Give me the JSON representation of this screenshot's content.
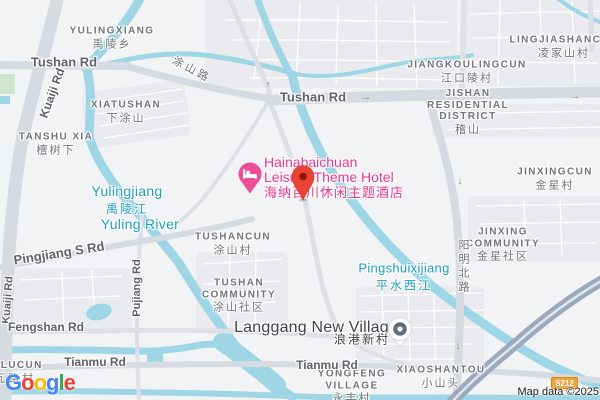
{
  "map": {
    "poi": {
      "hotel": {
        "name_line1": "Hainabaichuan",
        "name_line2": "Leisure Theme Hotel",
        "name_zh": "海纳百川休闲主题酒店",
        "pin_color": "#EF4C9A",
        "icon": "bed-icon"
      }
    },
    "markers": {
      "destination": {
        "color": "#E94335",
        "inner_color": "#971106"
      },
      "village_pin": {
        "color": "#5E6E7E"
      }
    },
    "areas": {
      "yulingxiang": {
        "en": "YULINGXIANG",
        "zh": "禹陵乡"
      },
      "lingjiashancun": {
        "en": "LINGJIASHANCUN",
        "zh": "凌家山村"
      },
      "jiangkoulingcun": {
        "en": "JIANGKOULINGCUN",
        "zh": "江口陵村"
      },
      "jishan": {
        "l1": "JISHAN",
        "l2": "RESIDENTIAL",
        "l3": "DISTRICT",
        "zh": "稽山"
      },
      "xiatushan": {
        "en": "XIATUSHAN",
        "zh": "下涂山"
      },
      "tanshu_xia": {
        "en": "TANSHU XIA",
        "zh": "檀树下"
      },
      "tushancun": {
        "en": "TUSHANCUN",
        "zh": "涂山村"
      },
      "tushan_community": {
        "l1": "TUSHAN",
        "l2": "COMMUNITY",
        "zh": "涂山社区"
      },
      "jinxingcun": {
        "en": "JINXINGCUN",
        "zh": "金星村"
      },
      "jinxing_community": {
        "l1": "JINXING",
        "l2": "COMMUNITY",
        "zh": "金星社区"
      },
      "langgang": {
        "en": "Langgang New Village",
        "zh": "浪港新村"
      },
      "yongfeng": {
        "l1": "YONGFENG",
        "l2": "VILLAGE",
        "zh": "永丰村"
      },
      "xiaoshantou": {
        "en": "XIAOSHANTOU",
        "zh": "小山头"
      },
      "hilucun": {
        "en": "HILUCUN",
        "zh": "瓦路村"
      }
    },
    "roads": {
      "tushan_rd_left": "Tushan Rd",
      "tushan_rd_right": "Tushan Rd",
      "tushan_lu_zh": "涂山路",
      "kuaiji_rd_top": "Kuaiji Rd",
      "kuaiji_rd_bottom": "Kuaiji Rd",
      "pingjiang_s_rd": "Pingjiang S Rd",
      "pujiang_rd": "Pujiang Rd",
      "yangming_n_rd_zh": "阳明北路",
      "fengshan_rd": "Fengshan Rd",
      "tianmu_rd_left": "Tianmu Rd",
      "tianmu_rd_mid": "Tianmu Rd",
      "route_shield": "S212"
    },
    "water": {
      "yulingjiang": {
        "en": "Yulingjiang",
        "zh": "禹陵江"
      },
      "yuling_river": "Yuling River",
      "pingshuixijiang": {
        "en": "Pingshuixijiang",
        "zh": "平水西江"
      }
    },
    "icons": {
      "arrow_up": "↑",
      "arrow_down": "↓",
      "arrow_right": "→"
    },
    "attribution": "Map data ©2025",
    "logo": {
      "letters": [
        {
          "ch": "G",
          "color": "#4285F4"
        },
        {
          "ch": "o",
          "color": "#EA4335"
        },
        {
          "ch": "o",
          "color": "#FBBC05"
        },
        {
          "ch": "g",
          "color": "#4285F4"
        },
        {
          "ch": "l",
          "color": "#34A853"
        },
        {
          "ch": "e",
          "color": "#EA4335"
        }
      ]
    },
    "colors": {
      "background": "#F2F3F4",
      "urban_block": "#E9EBEE",
      "water": "#9FD6E6",
      "water_label": "#1F9CBE",
      "major_road": "#D6DBE1",
      "minor_road": "#DDE1E6",
      "highway": "#9AA9BC",
      "shield_orange": "#F0A23C",
      "hotel_pink": "#E9368B",
      "marker_red": "#E94335",
      "area_label_gray": "#70757A"
    }
  }
}
